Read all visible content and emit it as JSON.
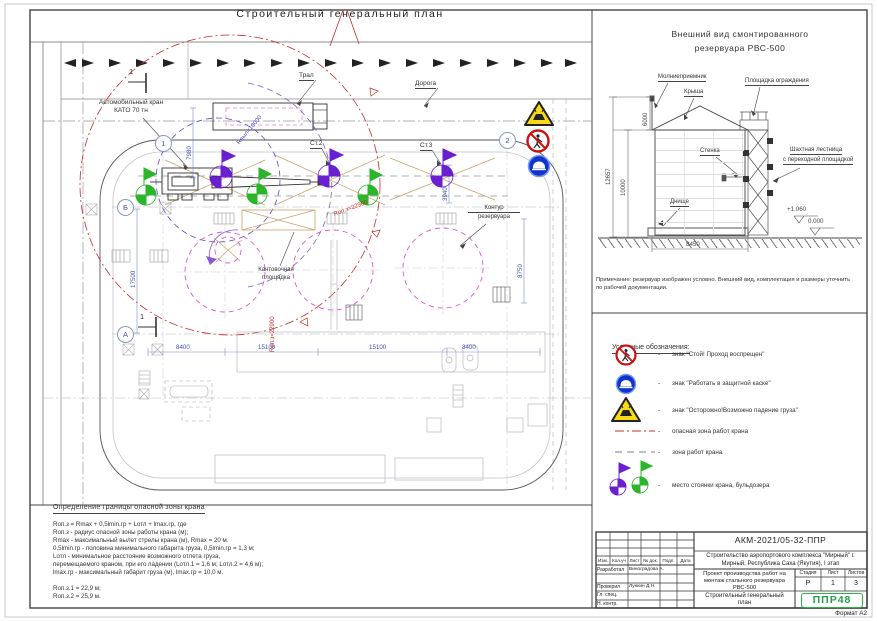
{
  "sheet": {
    "title": "Строительный генеральный план",
    "format": "Формат А2"
  },
  "colors": {
    "danger_red": "#c03028",
    "dim_blue": "#3f50b8",
    "zone_magenta": "#d957d9",
    "marker_green": "#2ab52a",
    "marker_purple": "#6a1fd0",
    "logo_green": "#1fa24a",
    "warning_yellow": "#f7d916",
    "sign_blue": "#1133cc"
  },
  "plan": {
    "labels": {
      "road": "Дорога",
      "trailer": "Трал",
      "crane1": "Автомобильный кран",
      "crane2": "КАТО 70 тн",
      "tilt1": "Кантовочная",
      "tilt2": "площадка",
      "contour1": "Контур",
      "contour2": "резервуара",
      "st2": "Ст.2",
      "st3": "Ст.3",
      "r_work": "Rвыл=10000",
      "r_danger": "Rоп.з=22900"
    },
    "dims": {
      "d17500": "17500",
      "d7980": "7980",
      "d3940": "3940",
      "d8750": "8750",
      "d8400a": "8400",
      "d15100a": "15100",
      "d15100b": "15100",
      "d8400b": "8400"
    },
    "axes": {
      "a1": "1",
      "a2": "2",
      "aA": "А",
      "aB": "Б",
      "section": "1"
    }
  },
  "elevation": {
    "title1": "Внешний вид смонтированного",
    "title2": "резервуара РВС-500",
    "labels": {
      "lightning": "Молниеприемник",
      "roof": "Крыша",
      "platform": "Площадка ограждения",
      "wall": "Стенка",
      "bottom": "Днище",
      "ladder1": "Шахтная лестница",
      "ladder2": "с переходной площадкой"
    },
    "dims": {
      "h12657": "12657",
      "h10000": "10000",
      "h6000": "6000",
      "w8450": "8450",
      "lvl1": "+1.060",
      "lvl0": "0.000"
    },
    "note1": "Примечание: резервуар изображен условно. Внешний вид, комплектация и размеры уточнить",
    "note2": "по рабочей документации."
  },
  "legend": {
    "header": "Условные обозначения:",
    "separator": "-",
    "items": [
      {
        "label": "знак \"Стой! Проход воспрещен\""
      },
      {
        "label": "знак \"Работать в защитной каске\""
      },
      {
        "label": "знак \"Осторожно!Возможно падение груза\""
      },
      {
        "label": "опасная зона работ крана"
      },
      {
        "label": "зона работ крана"
      },
      {
        "label": "место стоянки крана, бульдозера"
      }
    ]
  },
  "danger_zone_calc": {
    "header": "Определение границы опасной зоны крана",
    "lines": [
      "Rоп.з = Rmax + 0,5lmin.гр + Lотл + lmax.гр, где",
      "Rоп.з - радиус опасной зоны работы крана (м);",
      "Rmax - максимальный вылет стрелы крана (м), Rmax = 20 м.",
      "0,5lmin.гр - половина минимального габарита груза, 0,5lmin.гр = 1,3 м;",
      "Lотл - минимальное расстояние возможного отлета груза,",
      "перемещаемого краном, при его падении (Lотл.1 = 1,6 м; Lотл.2 = 4,6 м);",
      "lmax.гр - максимальный габарит груза (м), lmax.гр = 10,0 м."
    ],
    "result1": "Rоп.з.1 = 22,9 м;",
    "result2": "Rоп.з.2 = 25,9 м."
  },
  "titleblock": {
    "doc_number": "АКМ-2021/05-32-ППР",
    "project1": "Строительство аэропортового комплекса \"Мирный\" г.",
    "project2": "Мирный, Республика Саха (Якутия), I этап",
    "work1": "Проект производства работ на",
    "work2": "монтаж стального резервуара",
    "work3": "РВС-500",
    "sheet_name1": "Строительный генеральный",
    "sheet_name2": "план",
    "stage_header": "Стадия",
    "sheet_header": "Лист",
    "sheets_header": "Листов",
    "stage": "Р",
    "sheet": "1",
    "sheets": "3",
    "cols": {
      "izm": "Изм.",
      "koluch": "Кол.уч",
      "list": "Лист",
      "ndok": "№ док.",
      "podp": "Подп.",
      "data": "Дата"
    },
    "rows": [
      {
        "role": "Разработал",
        "name": "Виноградова А."
      },
      {
        "role": "",
        "name": ""
      },
      {
        "role": "Проверил",
        "name": "Лункин Д.Н."
      },
      {
        "role": "Гл. спец.",
        "name": ""
      },
      {
        "role": "Н. контр.",
        "name": ""
      }
    ],
    "logo": "ППР48"
  }
}
